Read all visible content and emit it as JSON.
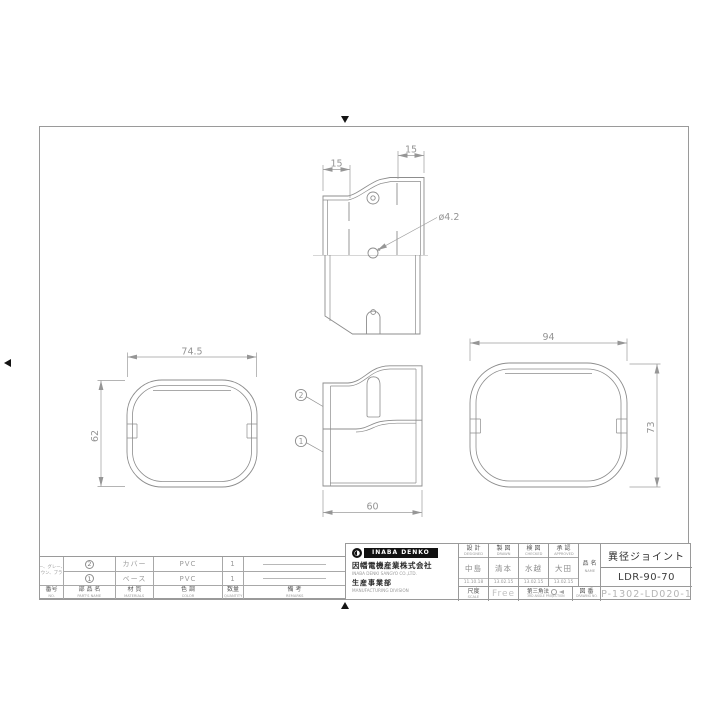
{
  "drawing": {
    "top_view": {
      "dim_left": "15",
      "dim_right": "15",
      "hole_callout": "ø4.2"
    },
    "left_view": {
      "width": "74.5",
      "height": "62"
    },
    "side_view": {
      "width": "60"
    },
    "right_view": {
      "width": "94",
      "height": "73"
    },
    "balloons": {
      "cover": "2",
      "base": "1"
    }
  },
  "parts_table": {
    "headers": {
      "no_jp": "番号",
      "no_en": "NO.",
      "name_jp": "部 品 名",
      "name_en": "PART'S NAME",
      "material_jp": "材 質",
      "material_en": "MATERIALS",
      "color_jp": "色 調",
      "color_en": "COLOR",
      "qty_jp": "数量",
      "qty_en": "QUANTITY",
      "remarks_jp": "備 考",
      "remarks_en": "REMARKS"
    },
    "rows": [
      {
        "no": "2",
        "name": "カバー",
        "material": "PVC",
        "qty": "1"
      },
      {
        "no": "1",
        "name": "ベース",
        "material": "PVC",
        "qty": "1"
      }
    ],
    "color_line1": "アイボリー、グレー、ホワイト",
    "color_line2": "ブラウン、ブラック"
  },
  "company": {
    "logo": "INABA DENKO",
    "name_jp": "因幡電機産業株式会社",
    "name_en": "INABA DENKI SANGYO CO.,LTD.",
    "division_jp": "生産事業部",
    "division_en": "MANUFACTURING DIVISION"
  },
  "approval": {
    "cols": [
      {
        "label_jp": "設 計",
        "label_en": "DESIGNED",
        "name": "中島",
        "date": "11.10.18"
      },
      {
        "label_jp": "製 図",
        "label_en": "DRAWN",
        "name": "清本",
        "date": "13.02.15"
      },
      {
        "label_jp": "検 図",
        "label_en": "CHECKED",
        "name": "水越",
        "date": "13.02.15"
      },
      {
        "label_jp": "承 認",
        "label_en": "APPROVED",
        "name": "大田",
        "date": "13.02.15"
      }
    ],
    "scale_jp": "尺度",
    "scale_en": "SCALE",
    "scale_value": "Free",
    "projection_jp": "第三角法",
    "projection_en": "3RD ANGLE PROJECTION",
    "dwg_jp": "図 番",
    "dwg_en": "DRAWING NO.",
    "name_jp": "品 名",
    "name_en": "NAME"
  },
  "title": {
    "product": "異径ジョイント",
    "model": "LDR-90-70",
    "number": "P-1302-LD020-1"
  }
}
